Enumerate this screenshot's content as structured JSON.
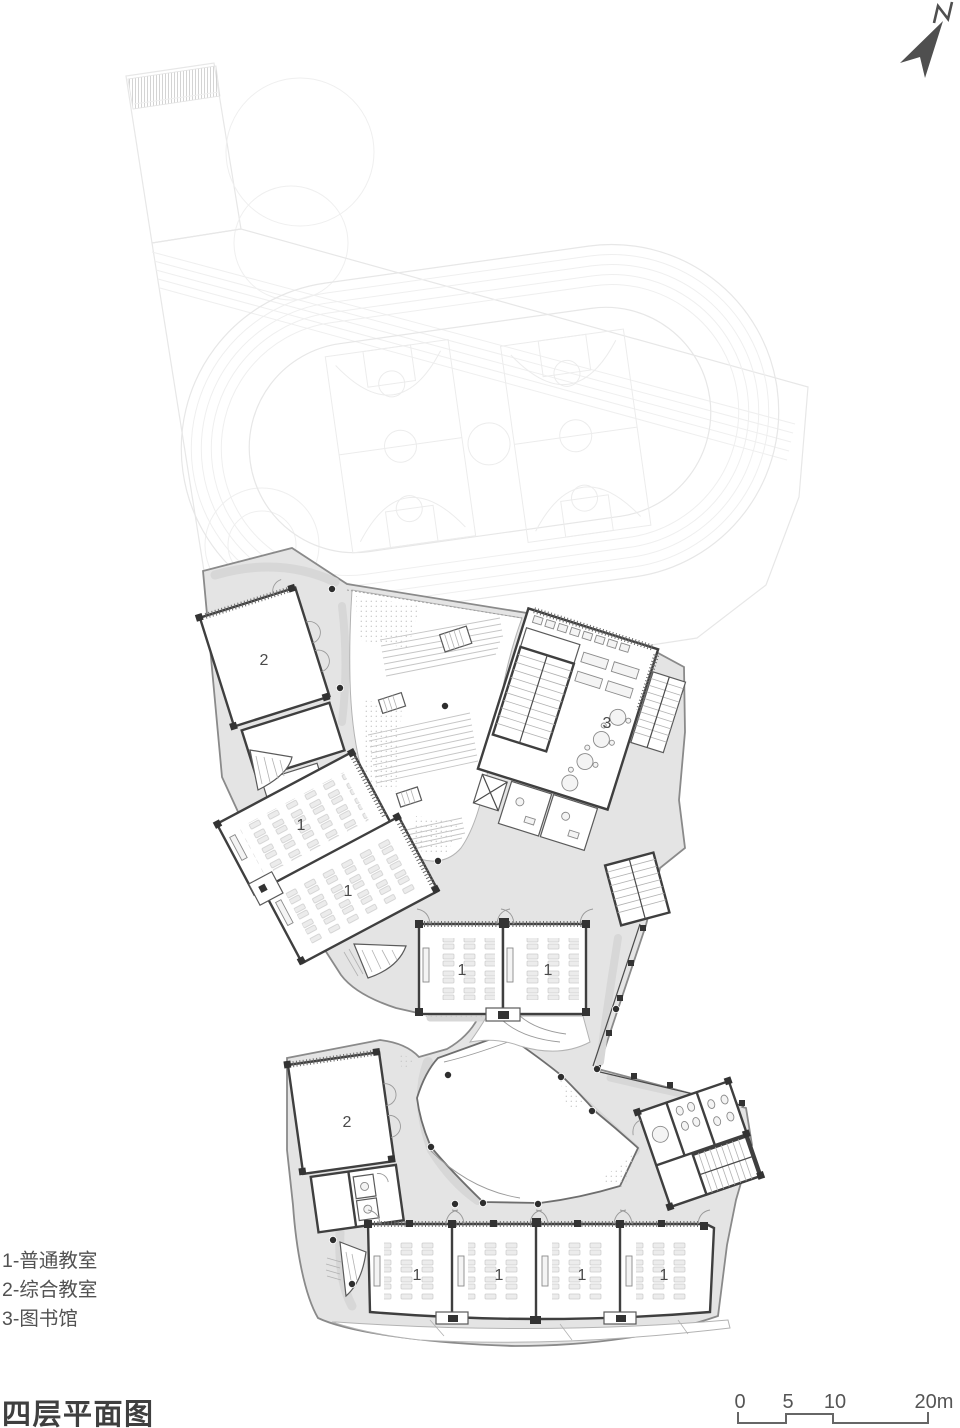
{
  "title": "四层平面图",
  "legend": {
    "items": [
      {
        "label": "1-普通教室"
      },
      {
        "label": "2-综合教室"
      },
      {
        "label": "3-图书馆"
      }
    ]
  },
  "north": {
    "label": "N"
  },
  "scale_bar": {
    "labels": [
      "0",
      "5",
      "10",
      "20m"
    ]
  },
  "rooms": [
    {
      "label": "2"
    },
    {
      "label": "1"
    },
    {
      "label": "1"
    },
    {
      "label": "1"
    },
    {
      "label": "1"
    },
    {
      "label": "3"
    },
    {
      "label": "2"
    },
    {
      "label": "1"
    },
    {
      "label": "1"
    },
    {
      "label": "1"
    },
    {
      "label": "1"
    }
  ],
  "colors": {
    "corridor_fill": "#e4e4e4",
    "wall": "#3f3f3f",
    "building_outline": "#8a8a8a",
    "site_line": "#e7e7e7",
    "room_label": "#4a4a4a",
    "north_arrow": "#4f4f4f",
    "title_text": "#3f3f3f"
  }
}
